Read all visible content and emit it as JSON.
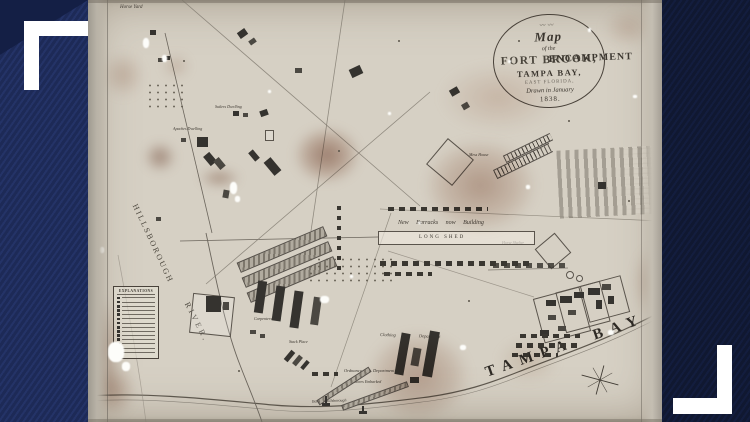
{
  "frame": {
    "top_left_icon": "corner-bracket-icon",
    "bottom_right_icon": "corner-bracket-icon",
    "colors": {
      "left_bar": "#1d2a57",
      "right_bar": "#101831",
      "bracket": "#ffffff"
    }
  },
  "map": {
    "title": {
      "ornament": "〰〰",
      "map": "Map",
      "of_the": "of the",
      "encampment": "ENCAMPMENT",
      "near": "near",
      "fort_brook": "FORT BROOK,",
      "tampa_bay": "TAMPA BAY,",
      "east_florida": "EAST FLORIDA,",
      "drawn": "Drawn in January",
      "year": "1838."
    },
    "labels": {
      "horse_yard": "Horse Yard",
      "sutlers_dwelling": "Sutlers Dwelling",
      "apaches_dwelling": "Apaches Dwelling",
      "hillsborough": "HILLSBOROUGH",
      "river": "RIVER.",
      "explanations": "EXPLANATIONS",
      "sheds": "Sheds",
      "carpenters_shop": "Carpenters Shop",
      "stack_place": "Stack Place",
      "new_barracks": "New Barracks now Building",
      "long_shed": "LONG SHED",
      "mess_house": "Mess House",
      "horse_shelter": "Horse Shelter",
      "clothing_department": "Clothing Department",
      "ordnance_department": "Ordnance Department",
      "stores_embarked": "Stores Embarked",
      "bank_of_hillsborough": "Bank of Hillsborough",
      "tampa_bay": "TAMPA BAY"
    },
    "colors": {
      "paper": "#d6d0c4",
      "ink": "#3b362f",
      "stain": "#9c6a50"
    }
  }
}
